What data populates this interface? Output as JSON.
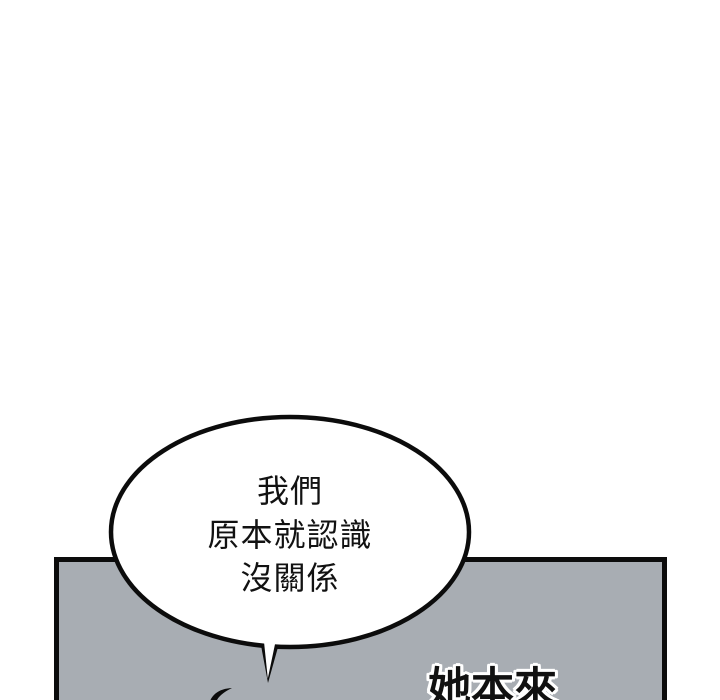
{
  "page": {
    "kind": "webtoon-comic-page"
  },
  "speech_bubble": {
    "lines": [
      "我們",
      "原本就認識",
      "沒關係"
    ]
  },
  "caption": {
    "text": "她本來"
  },
  "colors": {
    "panel_gray": "#a8adb3",
    "ink": "#0c0c0c",
    "bubble_fill": "#ffffff",
    "background": "#ffffff",
    "caption_outline": "#ffffff"
  }
}
